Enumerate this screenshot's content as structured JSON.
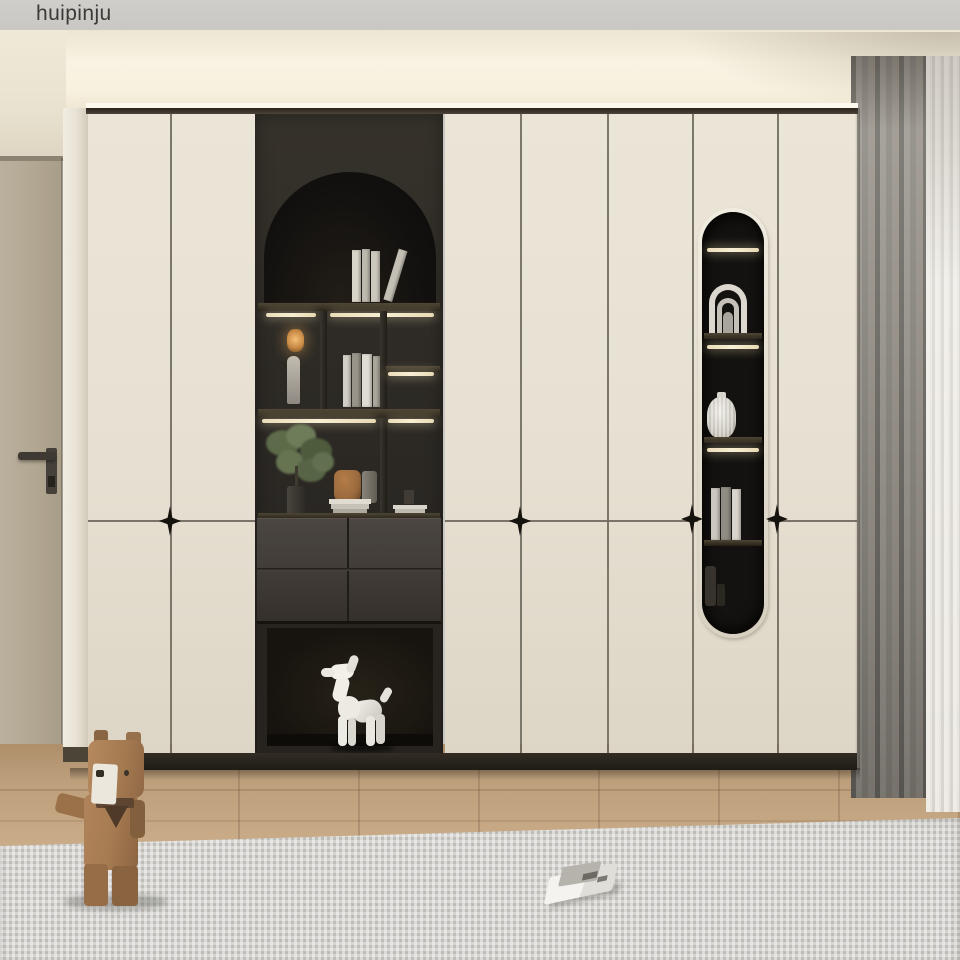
{
  "watermark": {
    "text": "huipinju"
  },
  "palette": {
    "ceiling-gray": "#c9c7c2",
    "cove-light": "#f8f3e2",
    "wall-upper": "#e9e2d0",
    "door-greige": "#b2a791",
    "pillar-white": "#f1ece1",
    "panel-cream": "#e7e0d2",
    "panel-seam": "#6e685c",
    "handle-black": "#16130f",
    "unit-charcoal": "#2d2a25",
    "niche-black": "#141210",
    "led-warm": "#f8eed3",
    "shelf-wood": "#4e4634",
    "drawer-gray": "#423d38",
    "floor-oak": "#c9ab87",
    "rug-gray": "#d5d4d0",
    "curtain-gray": "#8b8780",
    "curtain-sheer": "#e6e3dd",
    "bear-brown": "#a87c52",
    "sculpture-white": "#efede6",
    "plant-green": "#5d6b4a",
    "vase-brown": "#9a6a3d"
  },
  "objects": {
    "wardrobe": "cream wardrobe wall with charcoal display niches",
    "arch_niche": "arched bookcase niche with books",
    "table_lamp": "small warm lantern lamp",
    "figurine": "slender light figurine",
    "plant": "green plant in dark vase",
    "brown_vase": "brown ceramic vase",
    "stacked_books": "stacked books",
    "drawers": "charcoal push-open drawers",
    "balloon_dog": "white balloon-dog sculpture",
    "pill_niche": "pill-shaped lit display niche",
    "arch_ornament": "white nested-arch ornament",
    "ribbed_vase": "white ribbed vase",
    "bottles": "dark bottles",
    "interior_door": "greige interior door with black lever handle",
    "curtains": "gray curtain with white sheer",
    "wood_floor": "oak plank floor",
    "rug": "woven gray rug",
    "bear_figurine": "wooden low-poly bear toy",
    "open_book": "open book lying on rug"
  }
}
